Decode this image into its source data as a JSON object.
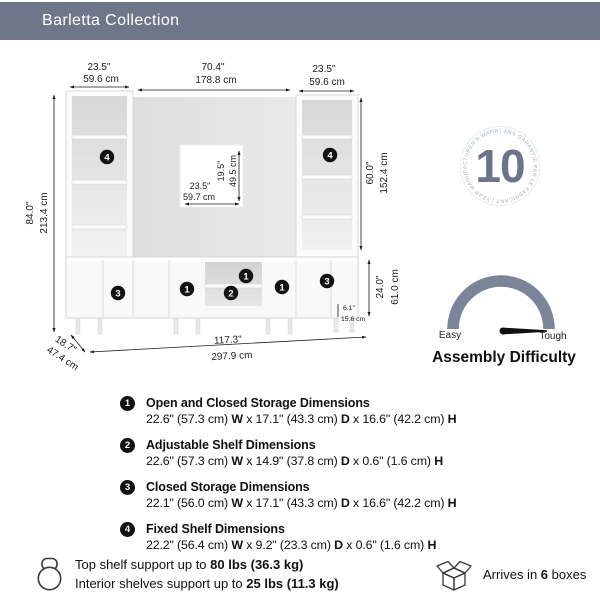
{
  "header": {
    "title": "Barletta Collection"
  },
  "colors": {
    "header_bg": "#6e7689",
    "accent": "#6b7488",
    "gauge_arc": "#7b8499",
    "marker_bg": "#121212"
  },
  "diagram": {
    "dims": {
      "tower_left_width": {
        "in": "23.5\"",
        "cm": "59.6 cm"
      },
      "center_width": {
        "in": "70.4\"",
        "cm": "178.8 cm"
      },
      "tower_right_width": {
        "in": "23.5\"",
        "cm": "59.6 cm"
      },
      "total_height": {
        "in": "84.0\"",
        "cm": "213.4 cm"
      },
      "tv_height": {
        "in": "19.5\"",
        "cm": "49.5 cm"
      },
      "tv_width": {
        "in": "23.5\"",
        "cm": "59.7 cm"
      },
      "tower_shelf_height": {
        "in": "60.0\"",
        "cm": "152.4 cm"
      },
      "console_height": {
        "in": "24.0\"",
        "cm": "61.0 cm"
      },
      "leg_height": {
        "in": "6.1\"",
        "cm": "15.6 cm"
      },
      "total_width": {
        "in": "117.3\"",
        "cm": "297.9 cm"
      },
      "depth": {
        "in": "18.7\"",
        "cm": "47.4 cm"
      }
    },
    "markers": {
      "tower_left": "4",
      "tower_right": "4",
      "console": [
        "3",
        "1",
        "1",
        "2",
        "1",
        "3"
      ]
    }
  },
  "warranty": {
    "number": "10",
    "ring_text": "|  ANS GARANTIE PAR LE FABRICANT  |  YEAR MANUFACTURER'S WARRANTY "
  },
  "assembly": {
    "title": "Assembly Difficulty",
    "easy_label": "Easy",
    "tough_label": "Tough"
  },
  "labels": {
    "w": "W",
    "d": "D",
    "h": "H",
    "sep": "x"
  },
  "specs": [
    {
      "num": "1",
      "title": "Open and Closed Storage Dimensions",
      "w": "22.6\" (57.3 cm)",
      "d": "17.1\" (43.3 cm)",
      "h": "16.6\" (42.2 cm)"
    },
    {
      "num": "2",
      "title": "Adjustable Shelf Dimensions",
      "w": "22.6\" (57.3 cm)",
      "d": "14.9\" (37.8 cm)",
      "h": "0.6\" (1.6 cm)"
    },
    {
      "num": "3",
      "title": "Closed Storage Dimensions",
      "w": "22.1\" (56.0 cm)",
      "d": "17.1\" (43.3 cm)",
      "h": "16.6\" (42.2 cm)"
    },
    {
      "num": "4",
      "title": "Fixed Shelf Dimensions",
      "w": "22.2\" (56.4 cm)",
      "d": "9.2\" (23.3 cm)",
      "h": "0.6\" (1.6 cm)"
    }
  ],
  "footer": {
    "support_line1_pre": "Top shelf support up to ",
    "support_line1_bold": "80 lbs (36.3 kg)",
    "support_line2_pre": "Interior shelves support up to ",
    "support_line2_bold": "25 lbs (11.3 kg)",
    "arrives_pre": "Arrives in ",
    "arrives_count": "6",
    "arrives_post": "boxes"
  }
}
